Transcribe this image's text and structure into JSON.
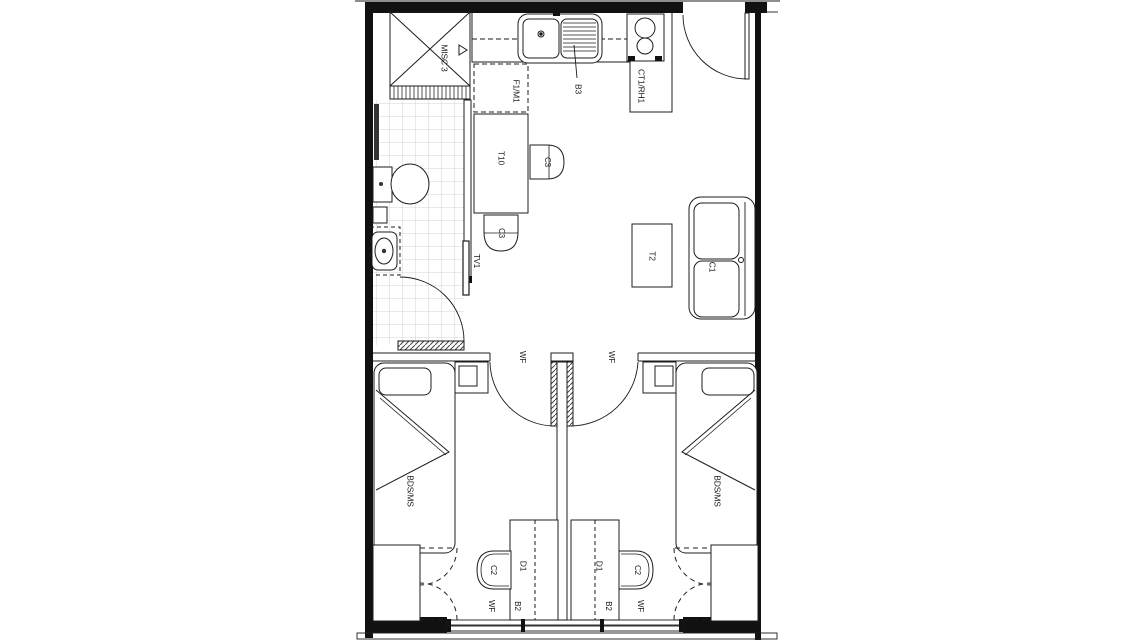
{
  "plan": {
    "colors": {
      "line": "#1c1c1c",
      "wall_fill": "#111111",
      "tile_line": "#c8c8c8",
      "background": "#ffffff"
    },
    "kitchen": {
      "shaft_label": "MISC 3",
      "appliance_label": "F1/M1",
      "sink_label": "B3",
      "cooktop_label": "CT1/RH1"
    },
    "living": {
      "dining_table_label": "T10",
      "dining_chair_top_label": "C3",
      "dining_chair_bottom_label": "C3",
      "tv_label": "TV1",
      "coffee_table_label": "T2",
      "sofa_label": "C1"
    },
    "hall": {
      "left_door_label": "WF",
      "right_door_label": "WF"
    },
    "bedroom_left": {
      "bed_label": "BDS/MS",
      "desk_label": "D1",
      "chair_label": "C2",
      "floor_label": "WF",
      "window_label": "B2"
    },
    "bedroom_right": {
      "bed_label": "BDS/MS",
      "desk_label": "D1",
      "chair_label": "C2",
      "floor_label": "WF",
      "window_label": "B2"
    }
  }
}
